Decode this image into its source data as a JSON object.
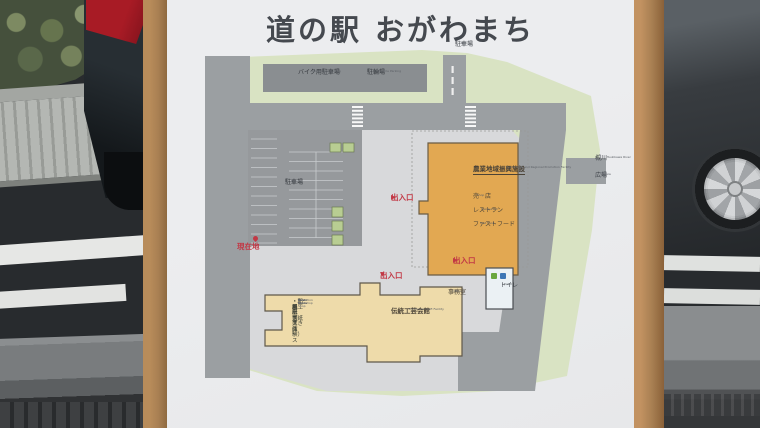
{
  "page": {
    "title_jp": "道の駅 おがわまち"
  },
  "labels": {
    "entrance": "出入口",
    "arrow_right": "▶",
    "arrow_down": "▼",
    "current_location": "現在地"
  },
  "areas": {
    "top_parking": {
      "jp": "駐車場",
      "en": "Parking"
    },
    "motorcycle_parking": {
      "jp": "バイク用駐車場",
      "en": "Motorcycle Parking"
    },
    "bicycle_parking": {
      "jp": "駐輪場",
      "en": "Bicycle Parking"
    },
    "main_parking": {
      "jp": "駐車場",
      "en": "Parking"
    },
    "river": {
      "jp": "槻川",
      "en": "Tsukikawa River"
    },
    "plaza": {
      "jp": "広場",
      "en": "Square"
    }
  },
  "buildings": {
    "main": {
      "jp": "農業地域振興施設",
      "en": "Agricultural and Regional Promotion Facility",
      "rooms": [
        {
          "jp": "売　店",
          "en": "Shop"
        },
        {
          "jp": "レストラン",
          "en": "Restaurant"
        },
        {
          "jp": "ファストフード",
          "en": "Fast Food"
        }
      ]
    },
    "toilet": {
      "jp": "トイレ",
      "en": "Toilet"
    },
    "craft": {
      "jp": "伝統工芸会館",
      "en": "Traditional Craft Facility",
      "features": [
        {
          "jp": "・和紙工房（紙すき体験）",
          "en": "Washi Workshop"
        },
        {
          "jp": "・和紙等売店",
          "en": "Washi etc. Shop"
        },
        {
          "jp": "・展示室",
          "en": "Exhibition Room"
        },
        {
          "jp": "・キッズスペース",
          "en": "Kids Space"
        }
      ],
      "office": {
        "jp": "事務室",
        "en": "Office"
      }
    }
  },
  "colors": {
    "frame_brown": "#a87f52",
    "panel": "#e9eaec",
    "site_green": "#d9e3c3",
    "road_gray": "#9b9fa2",
    "ground_gray": "#d8d9db",
    "dark_parking": "#8a8e91",
    "main_building_orange": "#e2a852",
    "craft_building_cream": "#eedbaa",
    "toilet_white": "#ebf1f4",
    "marker_red": "#c23845"
  }
}
